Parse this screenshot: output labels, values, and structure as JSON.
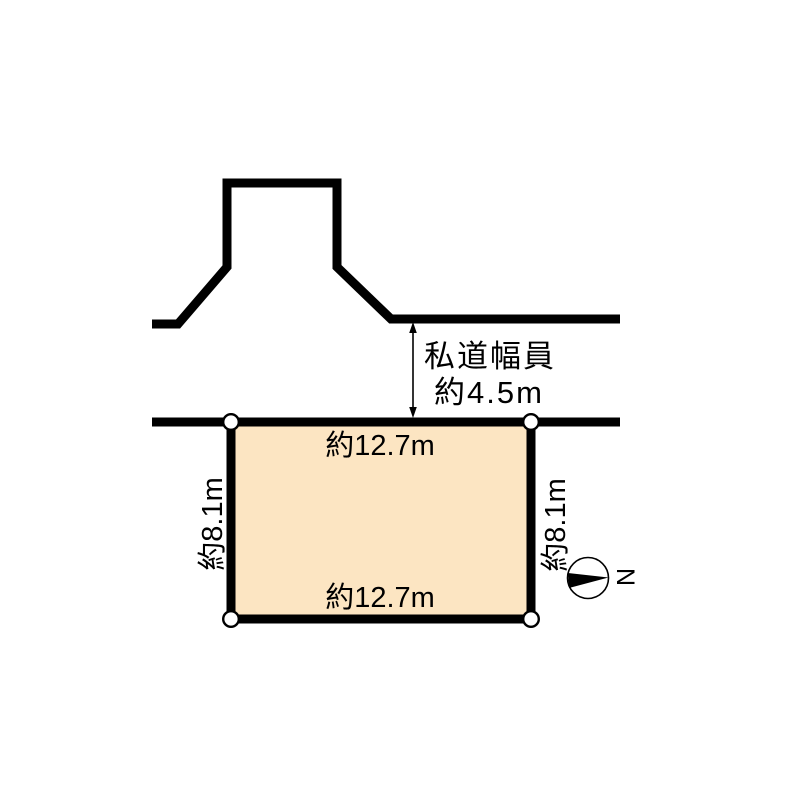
{
  "diagram": {
    "road": {
      "width_label_line1": "私道幅員",
      "width_label_line2": "約4.5m"
    },
    "lot": {
      "top_dimension": "約12.7m",
      "bottom_dimension": "約12.7m",
      "left_dimension": "約8.1m",
      "right_dimension": "約8.1m"
    },
    "compass": {
      "north_label": "N"
    },
    "colors": {
      "lot_fill": "#FCE5C2",
      "line": "#000000",
      "background": "#FFFFFF"
    }
  }
}
